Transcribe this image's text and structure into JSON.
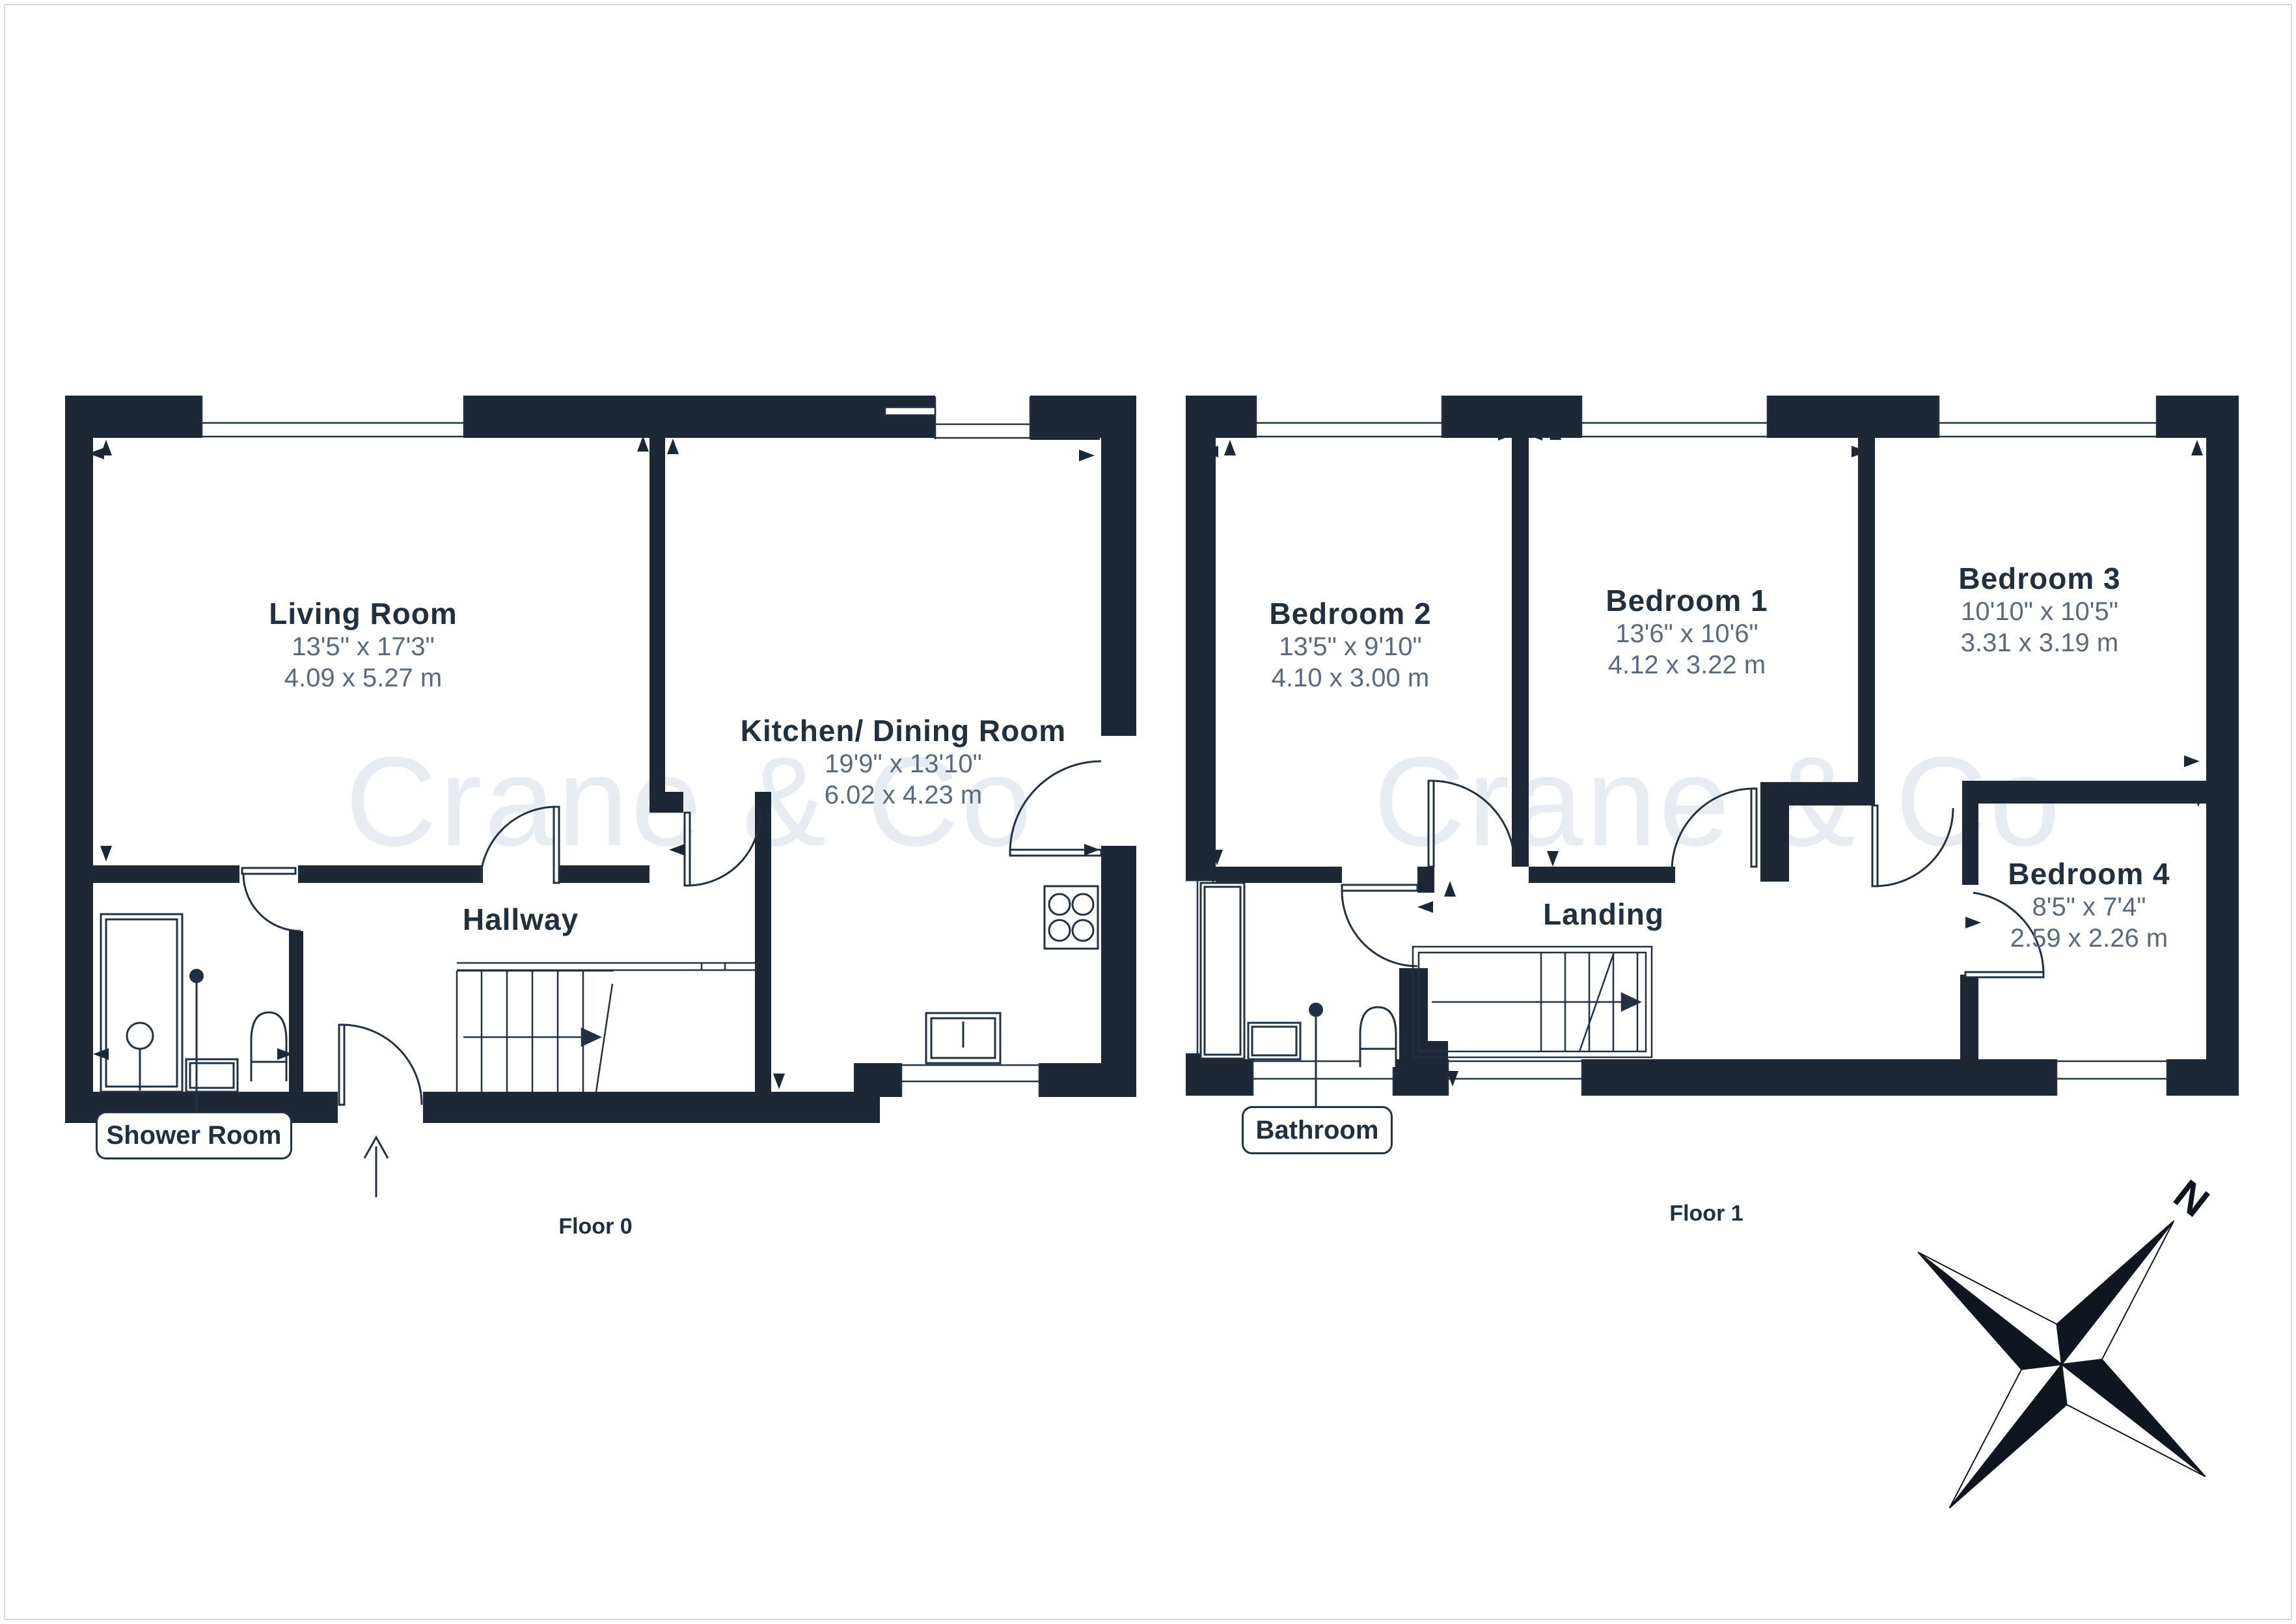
{
  "watermark": {
    "text": "Crane & Co",
    "color": "#e7ecf2"
  },
  "compass": {
    "north_label": "N"
  },
  "colors": {
    "wall": "#1d2836",
    "line": "#223043",
    "title_text": "#21303f",
    "dim_text": "#5a6a7c",
    "border": "#d8dce1"
  },
  "floors": [
    {
      "label": "Floor 0",
      "rooms": [
        {
          "name": "Living Room",
          "imperial": "13'5\" x 17'3\"",
          "metric": "4.09 x 5.27 m"
        },
        {
          "name": "Kitchen/ Dining Room",
          "imperial": "19'9\" x 13'10\"",
          "metric": "6.02 x 4.23 m"
        },
        {
          "name": "Hallway",
          "imperial": "",
          "metric": ""
        }
      ],
      "callout": "Shower Room"
    },
    {
      "label": "Floor 1",
      "rooms": [
        {
          "name": "Bedroom 2",
          "imperial": "13'5\" x 9'10\"",
          "metric": "4.10 x 3.00 m"
        },
        {
          "name": "Bedroom 1",
          "imperial": "13'6\" x 10'6\"",
          "metric": "4.12 x 3.22 m"
        },
        {
          "name": "Bedroom 3",
          "imperial": "10'10\" x 10'5\"",
          "metric": "3.31 x 3.19 m"
        },
        {
          "name": "Bedroom 4",
          "imperial": "8'5\" x 7'4\"",
          "metric": "2.59 x 2.26 m"
        },
        {
          "name": "Landing",
          "imperial": "",
          "metric": ""
        }
      ],
      "callout": "Bathroom"
    }
  ]
}
